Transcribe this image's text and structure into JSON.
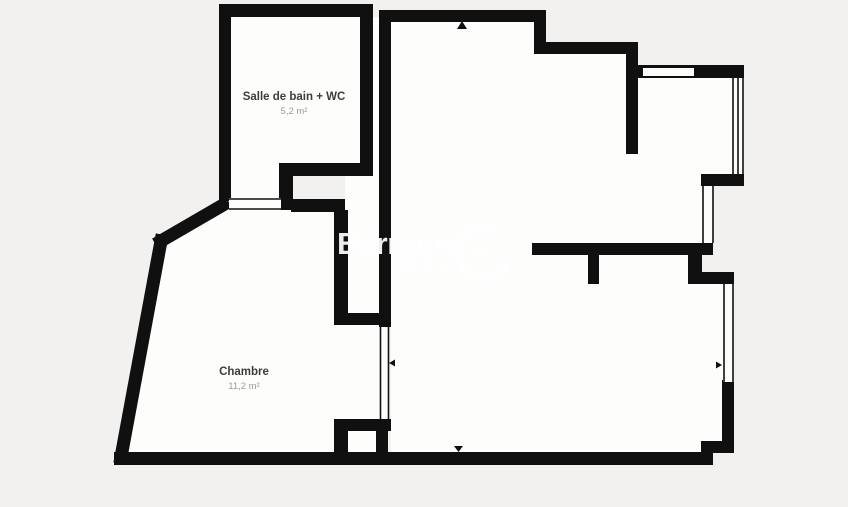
{
  "floor_plan": {
    "rooms": [
      {
        "name": "Salle de bain + WC",
        "area": "5,2 m²"
      },
      {
        "name": "Chambre",
        "area": "11,2 m²"
      }
    ],
    "watermark": {
      "brand": "Barraine",
      "sub": "IMMO"
    },
    "markers": [
      {
        "name": "entrance-arrow-top",
        "shape": "triangle-up"
      },
      {
        "name": "entrance-arrow-bottom",
        "shape": "triangle-down"
      },
      {
        "name": "door-arrow-left-window",
        "shape": "triangle-left"
      },
      {
        "name": "door-arrow-right-window",
        "shape": "triangle-right"
      }
    ],
    "colors": {
      "wall": "#101010",
      "background": "#f2f1ef",
      "interior": "#fdfdfc",
      "label": "#3d3d3d",
      "area_text": "#9b9b9b",
      "watermark": "#ffffff"
    }
  }
}
